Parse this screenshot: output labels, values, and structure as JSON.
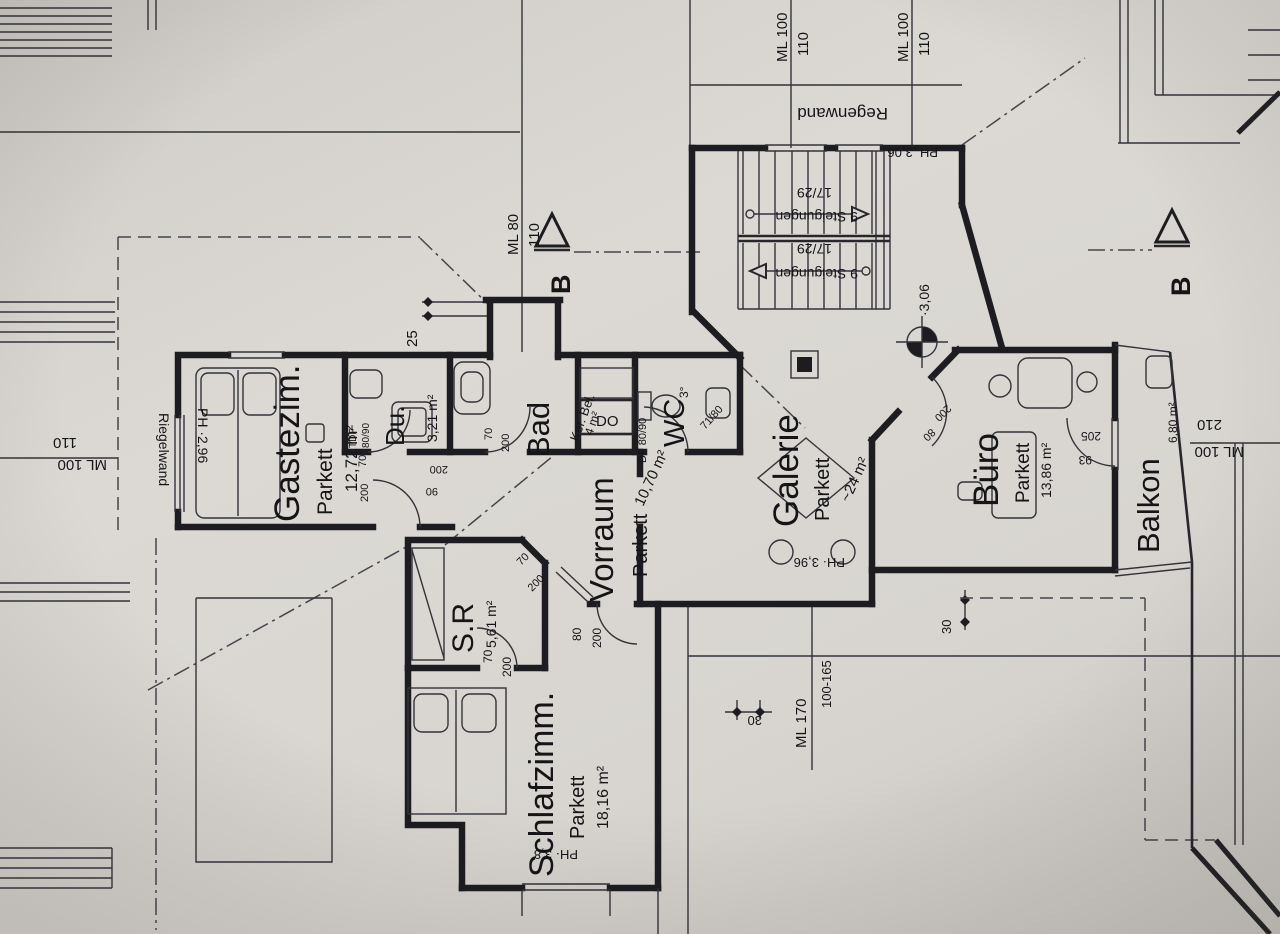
{
  "drawing": {
    "rooms": [
      {
        "name": "Gastezim.",
        "floor": "Parkett",
        "area": "12,72 m²"
      },
      {
        "name": "Du.",
        "area": "3,21 m²",
        "win1": "TDF",
        "win2": "80/90"
      },
      {
        "name": "Bad",
        "floor": "Ker. Bel.",
        "area": "4 m²"
      },
      {
        "name": "WC",
        "window": "DF 80/90",
        "slope": "3°",
        "door": "71/80"
      },
      {
        "name": "Vorraum",
        "floor": "Parkett",
        "area": "10,70 m²"
      },
      {
        "name": "S.R",
        "area": "5,61 m²"
      },
      {
        "name": "Schlafzimm.",
        "floor": "Parkett",
        "area": "18,16 m²"
      },
      {
        "name": "Galerie",
        "floor": "Parkett",
        "area": "~24 m²"
      },
      {
        "name": "Büro",
        "floor": "Parkett",
        "area": "13,86 m²"
      },
      {
        "name": "Balkon",
        "area": "6,80 m²"
      }
    ],
    "stairs": {
      "s1": "9 Steigungen",
      "r1": "17/29",
      "s2": "9 Steigungen",
      "r2": "17/29"
    },
    "labels": {
      "riegelwand": "Riegelwand",
      "regenwand": "Regenwand",
      "shaft": "DO",
      "ph_gast": "PH ·2,96",
      "ph_stairs": "PH .3,06",
      "ph_galerie": "PH· 3,96",
      "ph_schlaf": "PH· 3,8",
      "level_galerie": "·3,06"
    },
    "dims": {
      "ml80": "ML 80",
      "ml80b": "110",
      "mlA": "ML 100",
      "mlAb": "110",
      "mlB": "ML 100",
      "mlBb": "110",
      "mlLeft": "ML 100",
      "mlLeftb": "110",
      "mlRight": "ML 100",
      "mlRightb": "210",
      "ml170": "ML 170",
      "ml170b": "100-165",
      "d25": "25",
      "d30": "30",
      "d30b": "30"
    },
    "doors": {
      "gast1": "90",
      "gast2": "200",
      "du1": "70",
      "du2": "200",
      "bad1": "70",
      "bad2": "200",
      "sr1": "70",
      "sr2": "200",
      "srd1": "70",
      "srd2": "200",
      "schlaf1": "80",
      "schlaf2": "200",
      "buero1": "80",
      "buero2": "200",
      "balkon1": "93",
      "balkon2": "205"
    },
    "section": {
      "b_left": "B",
      "b_right": "B"
    }
  }
}
